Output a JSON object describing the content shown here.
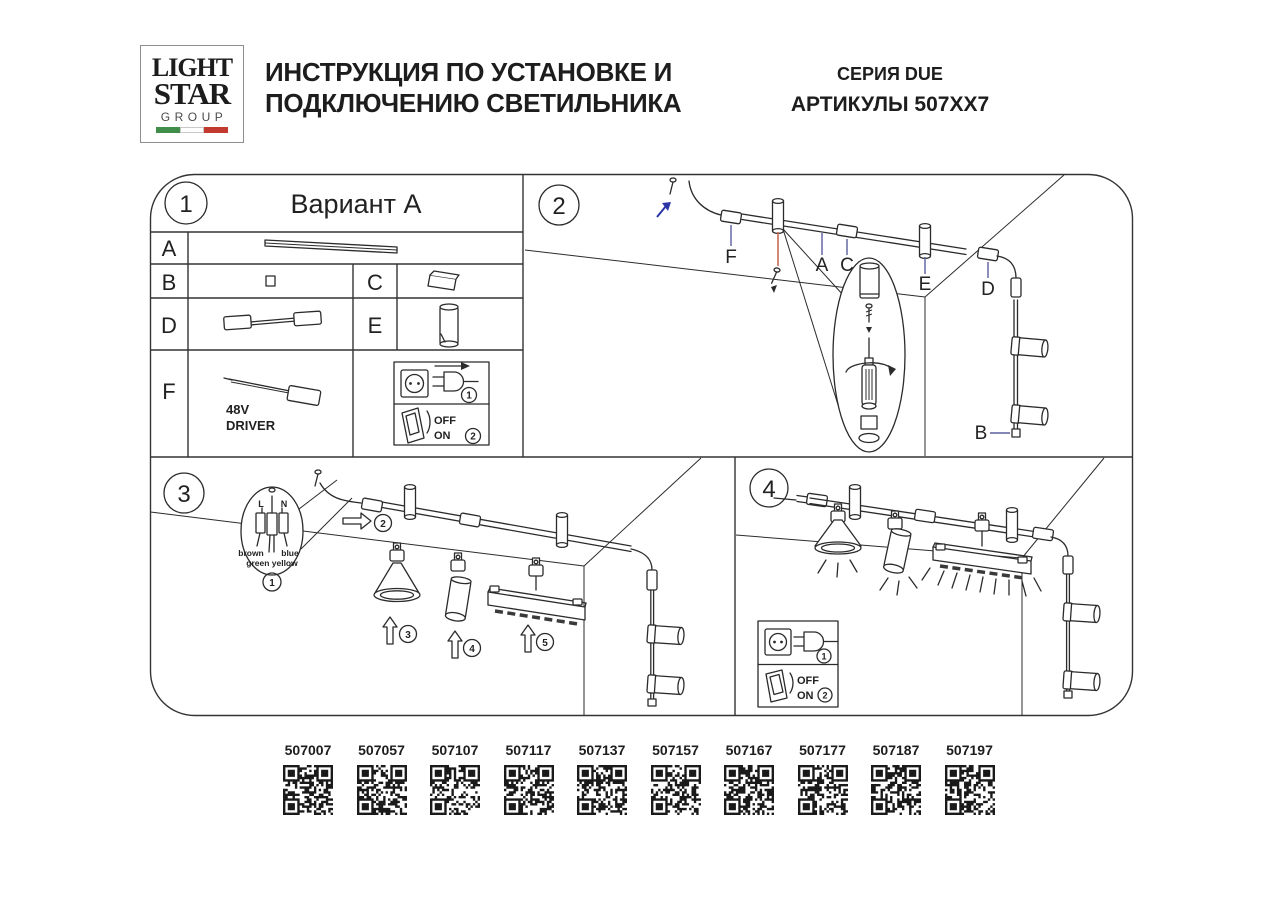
{
  "header": {
    "logo": {
      "line1": "LIGHT",
      "line2": "STAR",
      "line3": "GROUP"
    },
    "title_line1": "ИНСТРУКЦИЯ ПО УСТАНОВКЕ И",
    "title_line2": "ПОДКЛЮЧЕНИЮ СВЕТИЛЬНИКА",
    "series": "СЕРИЯ DUE",
    "articles": "АРТИКУЛЫ 507XX7"
  },
  "panel1": {
    "number": "1",
    "title": "Вариант A",
    "part_a": "A",
    "part_b": "B",
    "part_c": "C",
    "part_d": "D",
    "part_e": "E",
    "part_f": "F",
    "driver_voltage": "48V",
    "driver_label": "DRIVER",
    "power": {
      "step1": "1",
      "step2": "2",
      "off": "OFF",
      "on": "ON"
    }
  },
  "panel2": {
    "number": "2",
    "label_f": "F",
    "label_a": "A",
    "label_c": "C",
    "label_e": "E",
    "label_d": "D",
    "label_b": "B"
  },
  "panel3": {
    "number": "3",
    "wire_l": "L",
    "wire_n": "N",
    "wire_brown": "brown",
    "wire_blue": "blue",
    "wire_green_yellow": "green yellow",
    "step1": "1",
    "step2": "2",
    "step3": "3",
    "step4": "4",
    "step5": "5"
  },
  "panel4": {
    "number": "4",
    "power": {
      "step1": "1",
      "step2": "2",
      "off": "OFF",
      "on": "ON"
    }
  },
  "qr_codes": [
    {
      "label": "507007"
    },
    {
      "label": "507057"
    },
    {
      "label": "507107"
    },
    {
      "label": "507117"
    },
    {
      "label": "507137"
    },
    {
      "label": "507157"
    },
    {
      "label": "507167"
    },
    {
      "label": "507177"
    },
    {
      "label": "507187"
    },
    {
      "label": "507197"
    }
  ],
  "colors": {
    "line": "#2b2b2b",
    "accent_red": "#c96a55",
    "accent_blue": "#2b35a8",
    "leader_blue": "#5b5fa0",
    "flag_green": "#3f8f4a",
    "flag_red": "#c23a2f"
  }
}
